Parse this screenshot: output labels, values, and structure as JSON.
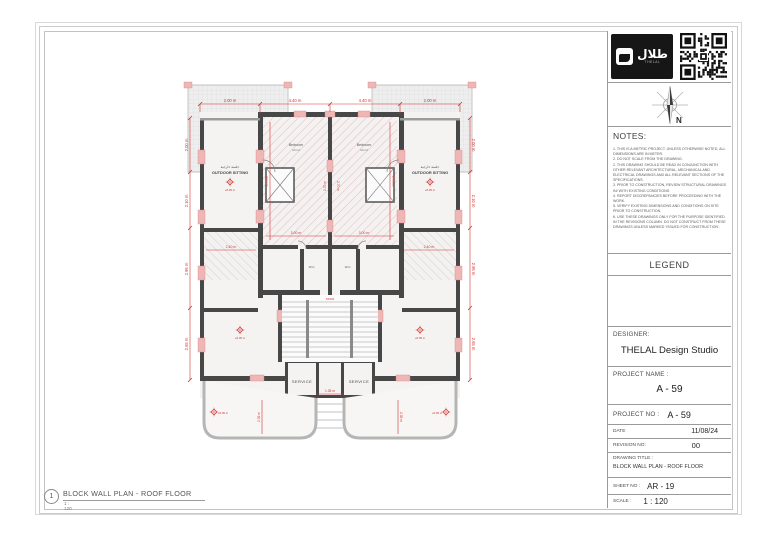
{
  "sheet": {
    "drawing_number": "1",
    "drawing_label": "BLOCK WALL PLAN - ROOF FLOOR",
    "drawing_scale": "1 : 120"
  },
  "title_block": {
    "logo": {
      "arabic": "طلال",
      "latin": "THELAL"
    },
    "north_label": "N",
    "notes_header": "NOTES:",
    "notes_text": "1. THIS IS A METRIC PROJECT. UNLESS OTHERWISE NOTED, ALL DIMENSIONS ARE IN METER.\n2. DO NOT SCALE FROM THE DRAWING.\n2. THIS DRAWING SHOULD BE READ IN CONJUNCTION WITH OTHER RELEVANT ARCHITECTURAL, MECHANICAL AND ELECTRICAL DRAWINGS AND ALL RELEVANT SECTIONS OF THE SPECIFICATIONS.\n3. PRIOR TO CONSTRUCTION, REVIEW STRUCTURAL DRAWINGS IN/ WITH EXISTING CONDITIONS.\n4. REPORT DISCREPANCIES BEFORE PROCEEDING WITH THE WORK.\n5. VERIFY EXISTING DIMENSIONS AND CONDITIONS ON SITE PRIOR TO CONSTRUCTION.\n6. USE THESE DRAWINGS ONLY FOR THE PURPOSE IDENTIFIED IN THE REVISIONS COLUMN. DO NOT CONSTRUCT FROM THESE DRAWINGS UNLESS MARKED 'ISSUED FOR CONSTRUCTION'.",
    "legend_header": "LEGEND",
    "designer_label": "DESIGNER:",
    "designer_value": "THELAL Design Studio",
    "project_name_label": "PROJECT NAME :",
    "project_name_value": "A - 59",
    "project_no_label": "PROJECT NO :",
    "project_no_value": "A - 59",
    "date_label": "DATE",
    "date_value": "11/08/24",
    "revision_label": "REVISION NO:",
    "revision_value": "00",
    "drawing_title_label": "DRAWING TITLE :",
    "drawing_title_value": "BLOCK WALL PLAN - ROOF FLOOR",
    "sheet_no_label": "SHEET NO :",
    "sheet_no_value": "AR - 19",
    "scale_label": "SCALE :",
    "scale_value": "1 : 120"
  },
  "plan": {
    "labels": {
      "outdoor_sitting_ar": "جلسة خارجية",
      "outdoor_sitting": "OUTDOOR SITTING",
      "bedroom": "Bedroom",
      "bedroom_area": "14 m²",
      "wc": "W.C.",
      "service": "SERVICE",
      "stair": "STAIR",
      "level": "+8.05 m"
    },
    "dims": {
      "top": [
        "2.00 m",
        "4.40 m",
        "4.40 m",
        "2.00 m"
      ],
      "side": [
        "2.00 m",
        "2.10 m",
        "2.95 m",
        "2.65 m"
      ],
      "bedroom_w": "3.00 m",
      "bedroom_h": "4.75 m",
      "spine": "2.70 m",
      "wing": "2.40 m",
      "walkway": "1.35 m",
      "terrace_h": "2.35 m"
    },
    "colors": {
      "dimension_red": "#d4322d",
      "wall_dark": "#474747",
      "column_pink": "#efb6b6"
    }
  }
}
